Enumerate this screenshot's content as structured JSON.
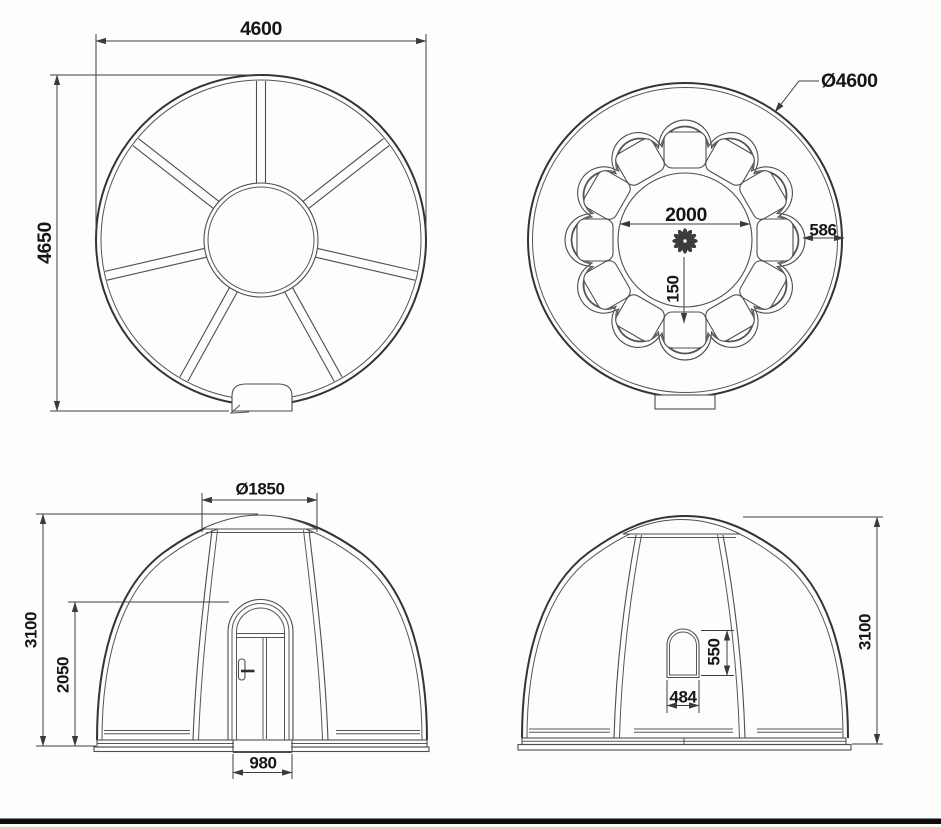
{
  "drawing": {
    "type": "dome pod technical drawing, four orthographic views",
    "colors": {
      "background": "#fdfdfc",
      "line": "#4e4e4e",
      "text": "#161616",
      "sheet_border": "#0d0d0d"
    },
    "views": {
      "frame_plan": {
        "width": "4600",
        "height": "4650",
        "spoke_count": 7
      },
      "interior_plan": {
        "outer_diameter": "Ø4600",
        "inner_diameter": "2000",
        "seat_to_wall": "586",
        "center_to_seat": "150",
        "seat_count": 12
      },
      "front_elevation": {
        "skylight_diameter": "Ø1850",
        "overall_height": "3100",
        "door_height": "2050",
        "door_width": "980"
      },
      "side_elevation": {
        "window_height": "550",
        "window_width": "484",
        "overall_height": "3100"
      }
    }
  }
}
